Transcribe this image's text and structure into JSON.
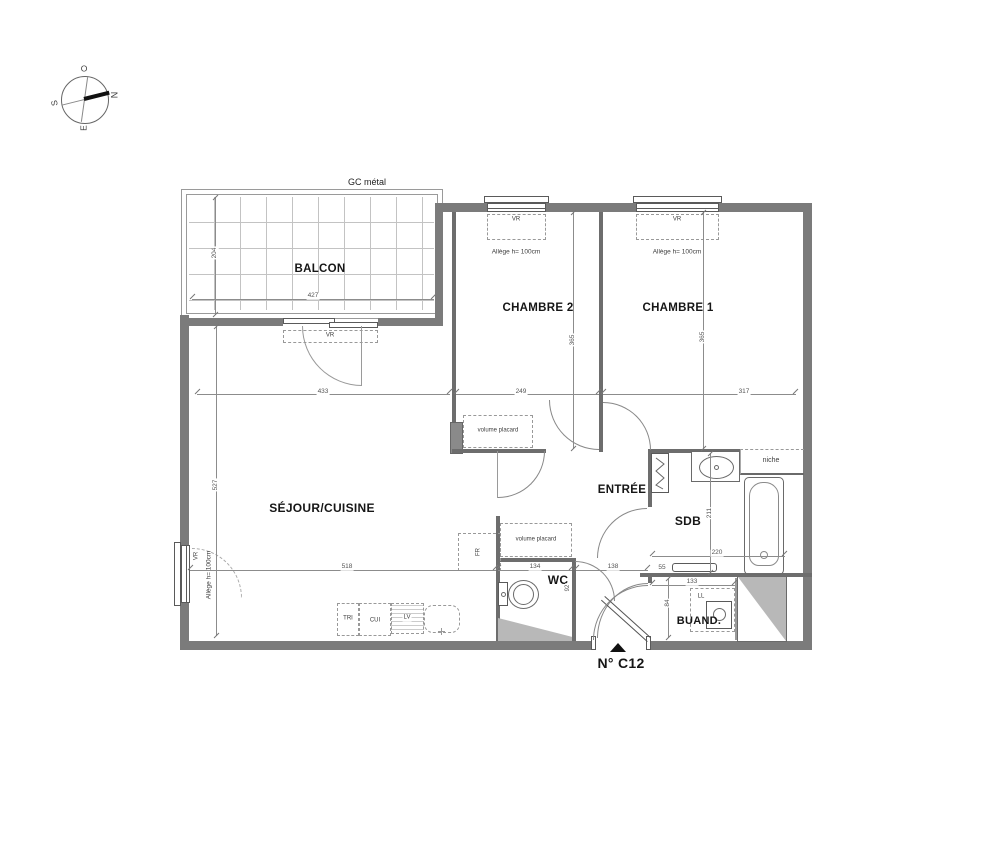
{
  "plan": {
    "unit_label": "N° C12",
    "railing_label": "GC métal"
  },
  "compass": {
    "north": "N",
    "south": "S",
    "east": "E",
    "west": "O"
  },
  "rooms": {
    "balcony": "BALCON",
    "bedroom2": "CHAMBRE 2",
    "bedroom1": "CHAMBRE 1",
    "living": "SÉJOUR/CUISINE",
    "entry": "ENTRÉE",
    "bathroom": "SDB",
    "wc": "WC",
    "laundry": "BUAND.",
    "niche": "niche"
  },
  "fixtures": {
    "closet": "volume placard",
    "fridge": "FR",
    "sorting": "TRI",
    "cooker": "CUI",
    "dishwasher": "LV",
    "washer": "LL"
  },
  "windows": {
    "shutter": "VR",
    "sill_note": "Allège h= 100cm"
  },
  "dimensions": {
    "balcony_width": "427",
    "balcony_depth": "204",
    "living_top": "433",
    "bedroom2_width": "249",
    "bedroom1_width": "317",
    "bedroom2_depth": "365",
    "bedroom1_depth": "365",
    "living_height": "527",
    "living_width": "518",
    "wc_width": "134",
    "hall_width": "138",
    "laundry_width": "133",
    "bath_width": "220",
    "bath_depth": "211",
    "shelf": "55",
    "laundry_depth": "84",
    "wc_depth": "92"
  }
}
